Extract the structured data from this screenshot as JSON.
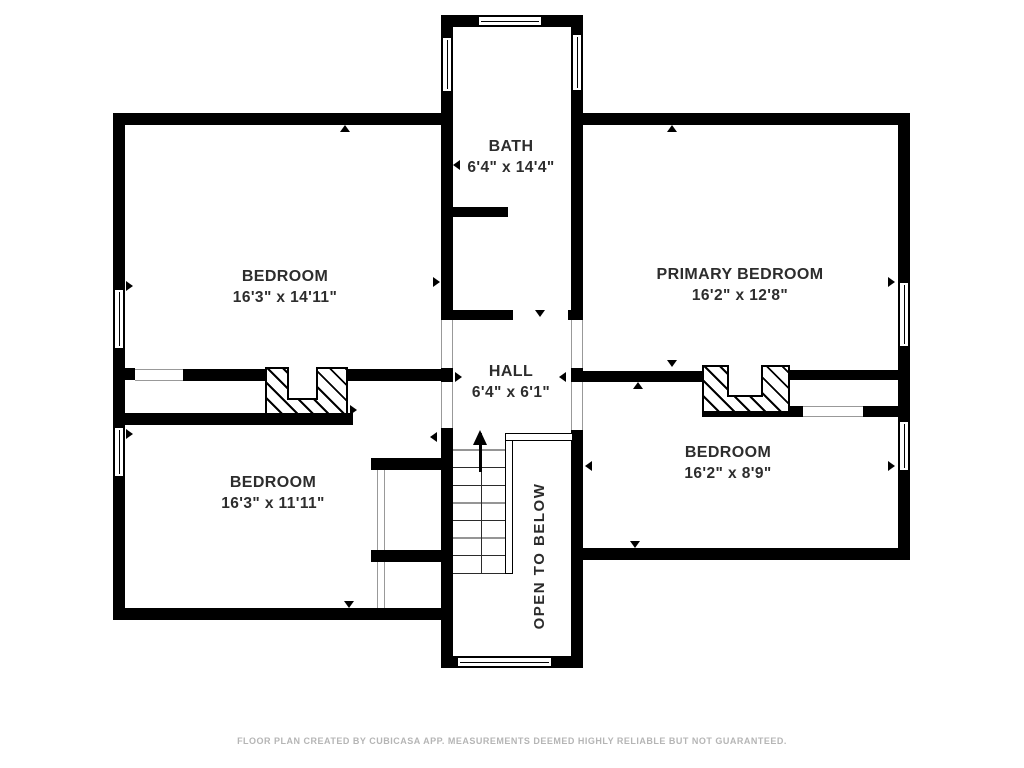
{
  "rooms": {
    "bath": {
      "name": "BATH",
      "dims": "6'4\" x 14'4\""
    },
    "bedroom_nw": {
      "name": "BEDROOM",
      "dims": "16'3\" x 14'11\""
    },
    "primary": {
      "name": "PRIMARY BEDROOM",
      "dims": "16'2\" x 12'8\""
    },
    "hall": {
      "name": "HALL",
      "dims": "6'4\" x 6'1\""
    },
    "bedroom_sw": {
      "name": "BEDROOM",
      "dims": "16'3\" x 11'11\""
    },
    "bedroom_se": {
      "name": "BEDROOM",
      "dims": "16'2\" x 8'9\""
    },
    "open_below": {
      "name": "OPEN TO BELOW"
    }
  },
  "footer": "FLOOR PLAN CREATED BY CUBICASA APP. MEASUREMENTS DEEMED HIGHLY RELIABLE BUT NOT GUARANTEED.",
  "colors": {
    "wall": "#000000",
    "text": "#2d2d2d",
    "disclaimer": "#b5b5b5"
  }
}
